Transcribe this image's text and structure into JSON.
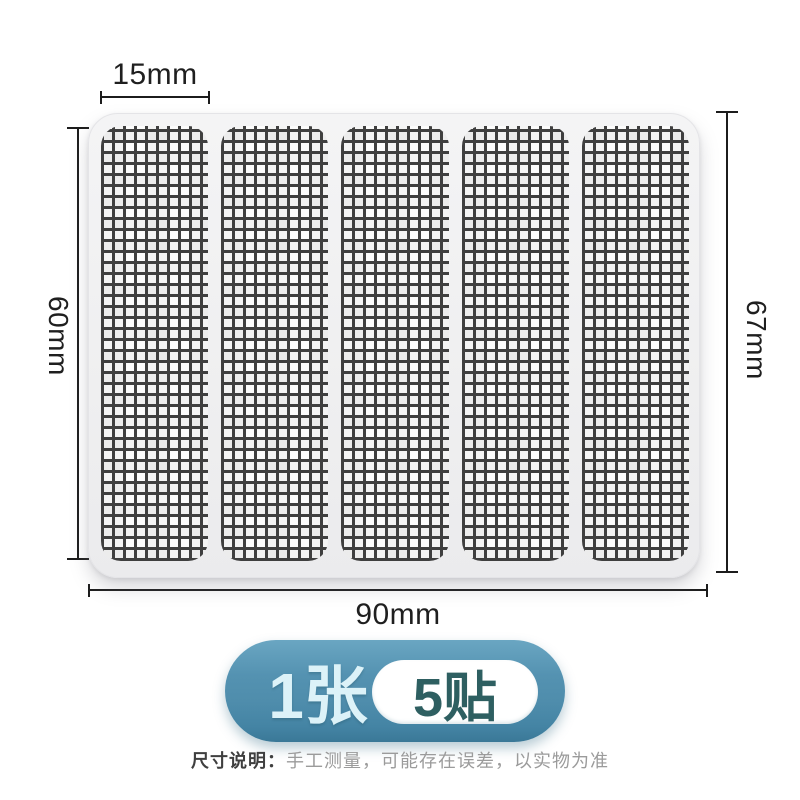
{
  "dimensions": {
    "strip_width": "15mm",
    "strip_height": "60mm",
    "sheet_height": "67mm",
    "sheet_width": "90mm"
  },
  "product": {
    "strip_count": 5
  },
  "badge": {
    "sheet_count_label": "1张",
    "patch_count_label": "5贴"
  },
  "note": {
    "title": "尺寸说明：",
    "body": "手工测量，可能存在误差，以实物为准"
  },
  "colors": {
    "badge_blue": "#4f8dac",
    "badge_blue_dark": "#3a7897",
    "badge_count_text": "#dcf2f8",
    "patch_pill_text": "#2e5f61",
    "mesh_line": "#3f3f3f",
    "sheet_fill": "#f0f0f1",
    "dimension_line": "#1c1c1c",
    "note_title_color": "#3f3f3f",
    "note_body_color": "#9b9b9b"
  }
}
